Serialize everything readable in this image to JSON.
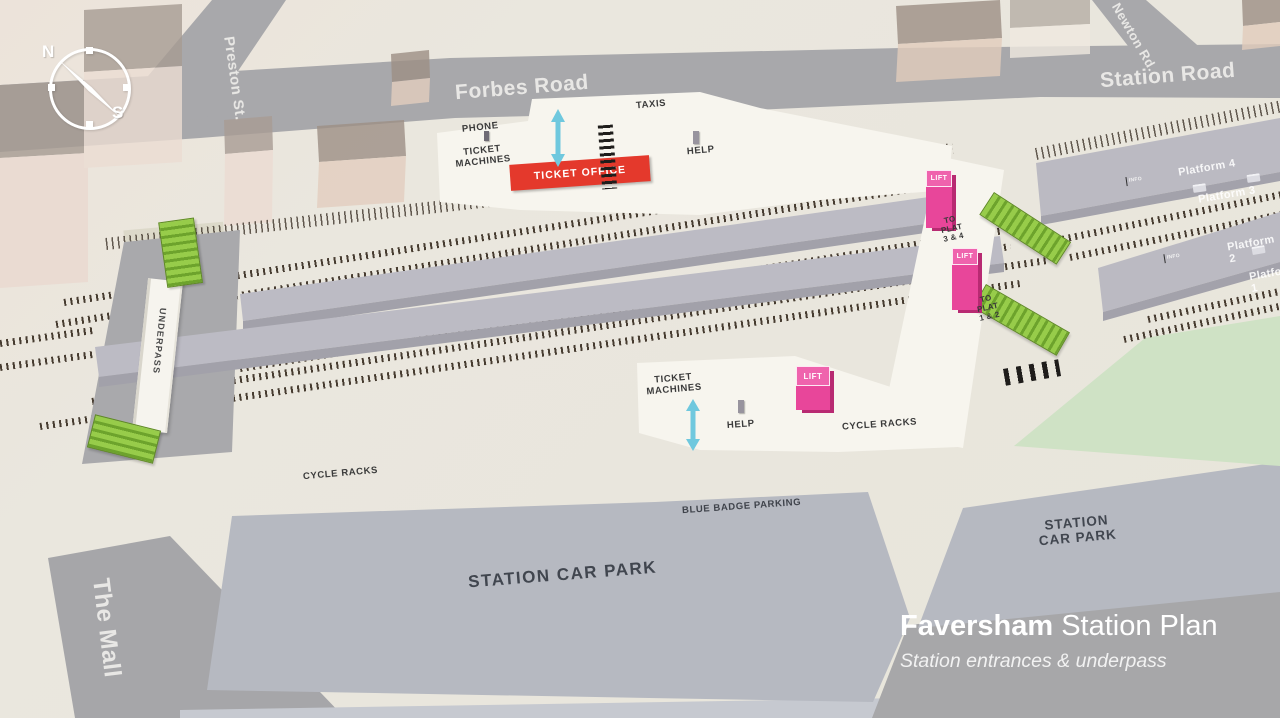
{
  "map": {
    "compass": {
      "n": "N",
      "s": "S"
    },
    "roads": {
      "preston": "Preston St.",
      "forbes": "Forbes Road",
      "newton": "Newton Rd.",
      "station": "Station Road",
      "mall": "The Mall"
    },
    "north_entrance": {
      "phone": "PHONE",
      "ticket_machines": "TICKET\nMACHINES",
      "ticket_office": "TICKET OFFICE",
      "taxis": "TAXIS",
      "help": "HELP"
    },
    "south_entrance": {
      "ticket_machines": "TICKET\nMACHINES",
      "help": "HELP",
      "cycle_racks": "CYCLE RACKS"
    },
    "platforms": {
      "p4": "Platform 4",
      "p3": "Platform 3",
      "p2": "Platform 2",
      "p1": "Platform 1",
      "info": "INFO"
    },
    "wayfinding": {
      "underpass": "UNDERPASS",
      "to_plat_34": "TO\nPLAT\n3 & 4",
      "to_plat_12": "TO\nPLAT\n1 & 2",
      "lift": "LIFT"
    },
    "parking": {
      "main": "STATION CAR PARK",
      "right": "STATION\nCAR PARK",
      "blue_badge": "BLUE BADGE PARKING",
      "cycle_racks_west": "CYCLE RACKS"
    },
    "title": {
      "bold": "Faversham",
      "rest": "Station Plan",
      "subtitle": "Station entrances & underpass"
    },
    "colors": {
      "lift_pink": "#e8469a",
      "stair_green": "#8dc63f",
      "office_red": "#e4392c",
      "arrow_cyan": "#6fc8de",
      "road_gray": "#a8a8ab",
      "carpark_gray": "#b6b9c1",
      "grass_green": "#cfe2c5"
    }
  }
}
